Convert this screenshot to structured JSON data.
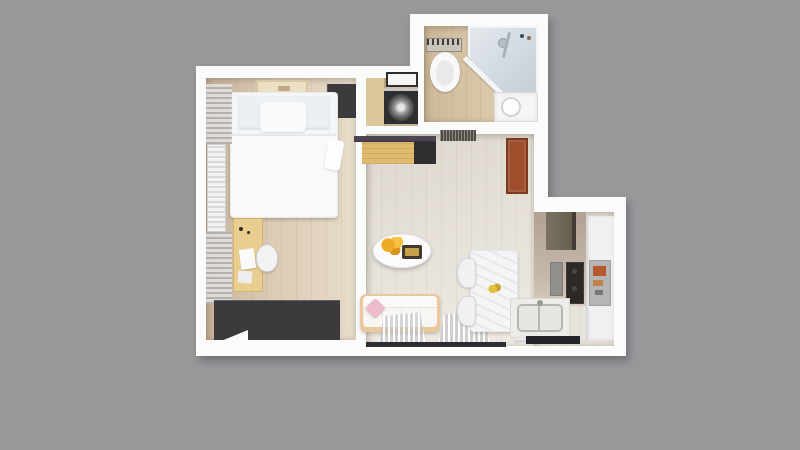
{
  "scene": {
    "type": "3d-floorplan-top-view-render",
    "no_visible_text": true
  },
  "colors": {
    "background": "#98979a",
    "wall": "#fbfbfb",
    "bedroomFloor": "#dccbb5",
    "bedroomFloorDark": "#c8b49c",
    "hallFloor": "#d2c2a5",
    "bathFloor": "#dbc9ac",
    "livingFloor": "#e7e2da",
    "wardrobe": "#3b3b3d",
    "bed": "#f3f5f7",
    "desk": "#eace90",
    "oak": "#debb6f",
    "shelf": "#4d4454",
    "sofaTrim": "#eac89c",
    "pillow": "#ecbccb",
    "flower": "#f0ab24",
    "door": "#9e4e2c",
    "stove": "#2b2826",
    "glass": "#c3cdd5",
    "sill": "#2d2d34"
  },
  "rooms": [
    {
      "name": "bedroom",
      "furniture": [
        "double-bed",
        "pillow",
        "blanket",
        "wardrobe-top",
        "wardrobe-bottom",
        "desk",
        "desk-chair",
        "radiator",
        "curtain-top",
        "curtain-bottom",
        "ceiling-light"
      ]
    },
    {
      "name": "hallway",
      "furniture": [
        "wood-cabinet",
        "wall-shelf",
        "washing-machine"
      ]
    },
    {
      "name": "bathroom",
      "furniture": [
        "toilet",
        "corner-shower",
        "shower-head",
        "vanity-cabinet",
        "round-sink"
      ]
    },
    {
      "name": "living-room",
      "furniture": [
        "wall-shelf-strip",
        "oak-sideboard",
        "doormat",
        "entry-door",
        "oval-coffee-table",
        "flower-vase",
        "tray",
        "sofa",
        "pink-pillow",
        "sheer-curtains",
        "dining-table",
        "dining-chair",
        "dining-chair",
        "picture-frame"
      ]
    },
    {
      "name": "kitchen",
      "furniture": [
        "upper-cabinet",
        "stove",
        "fridge",
        "fridge-shelf",
        "double-sink",
        "counter",
        "window-sill"
      ]
    }
  ]
}
